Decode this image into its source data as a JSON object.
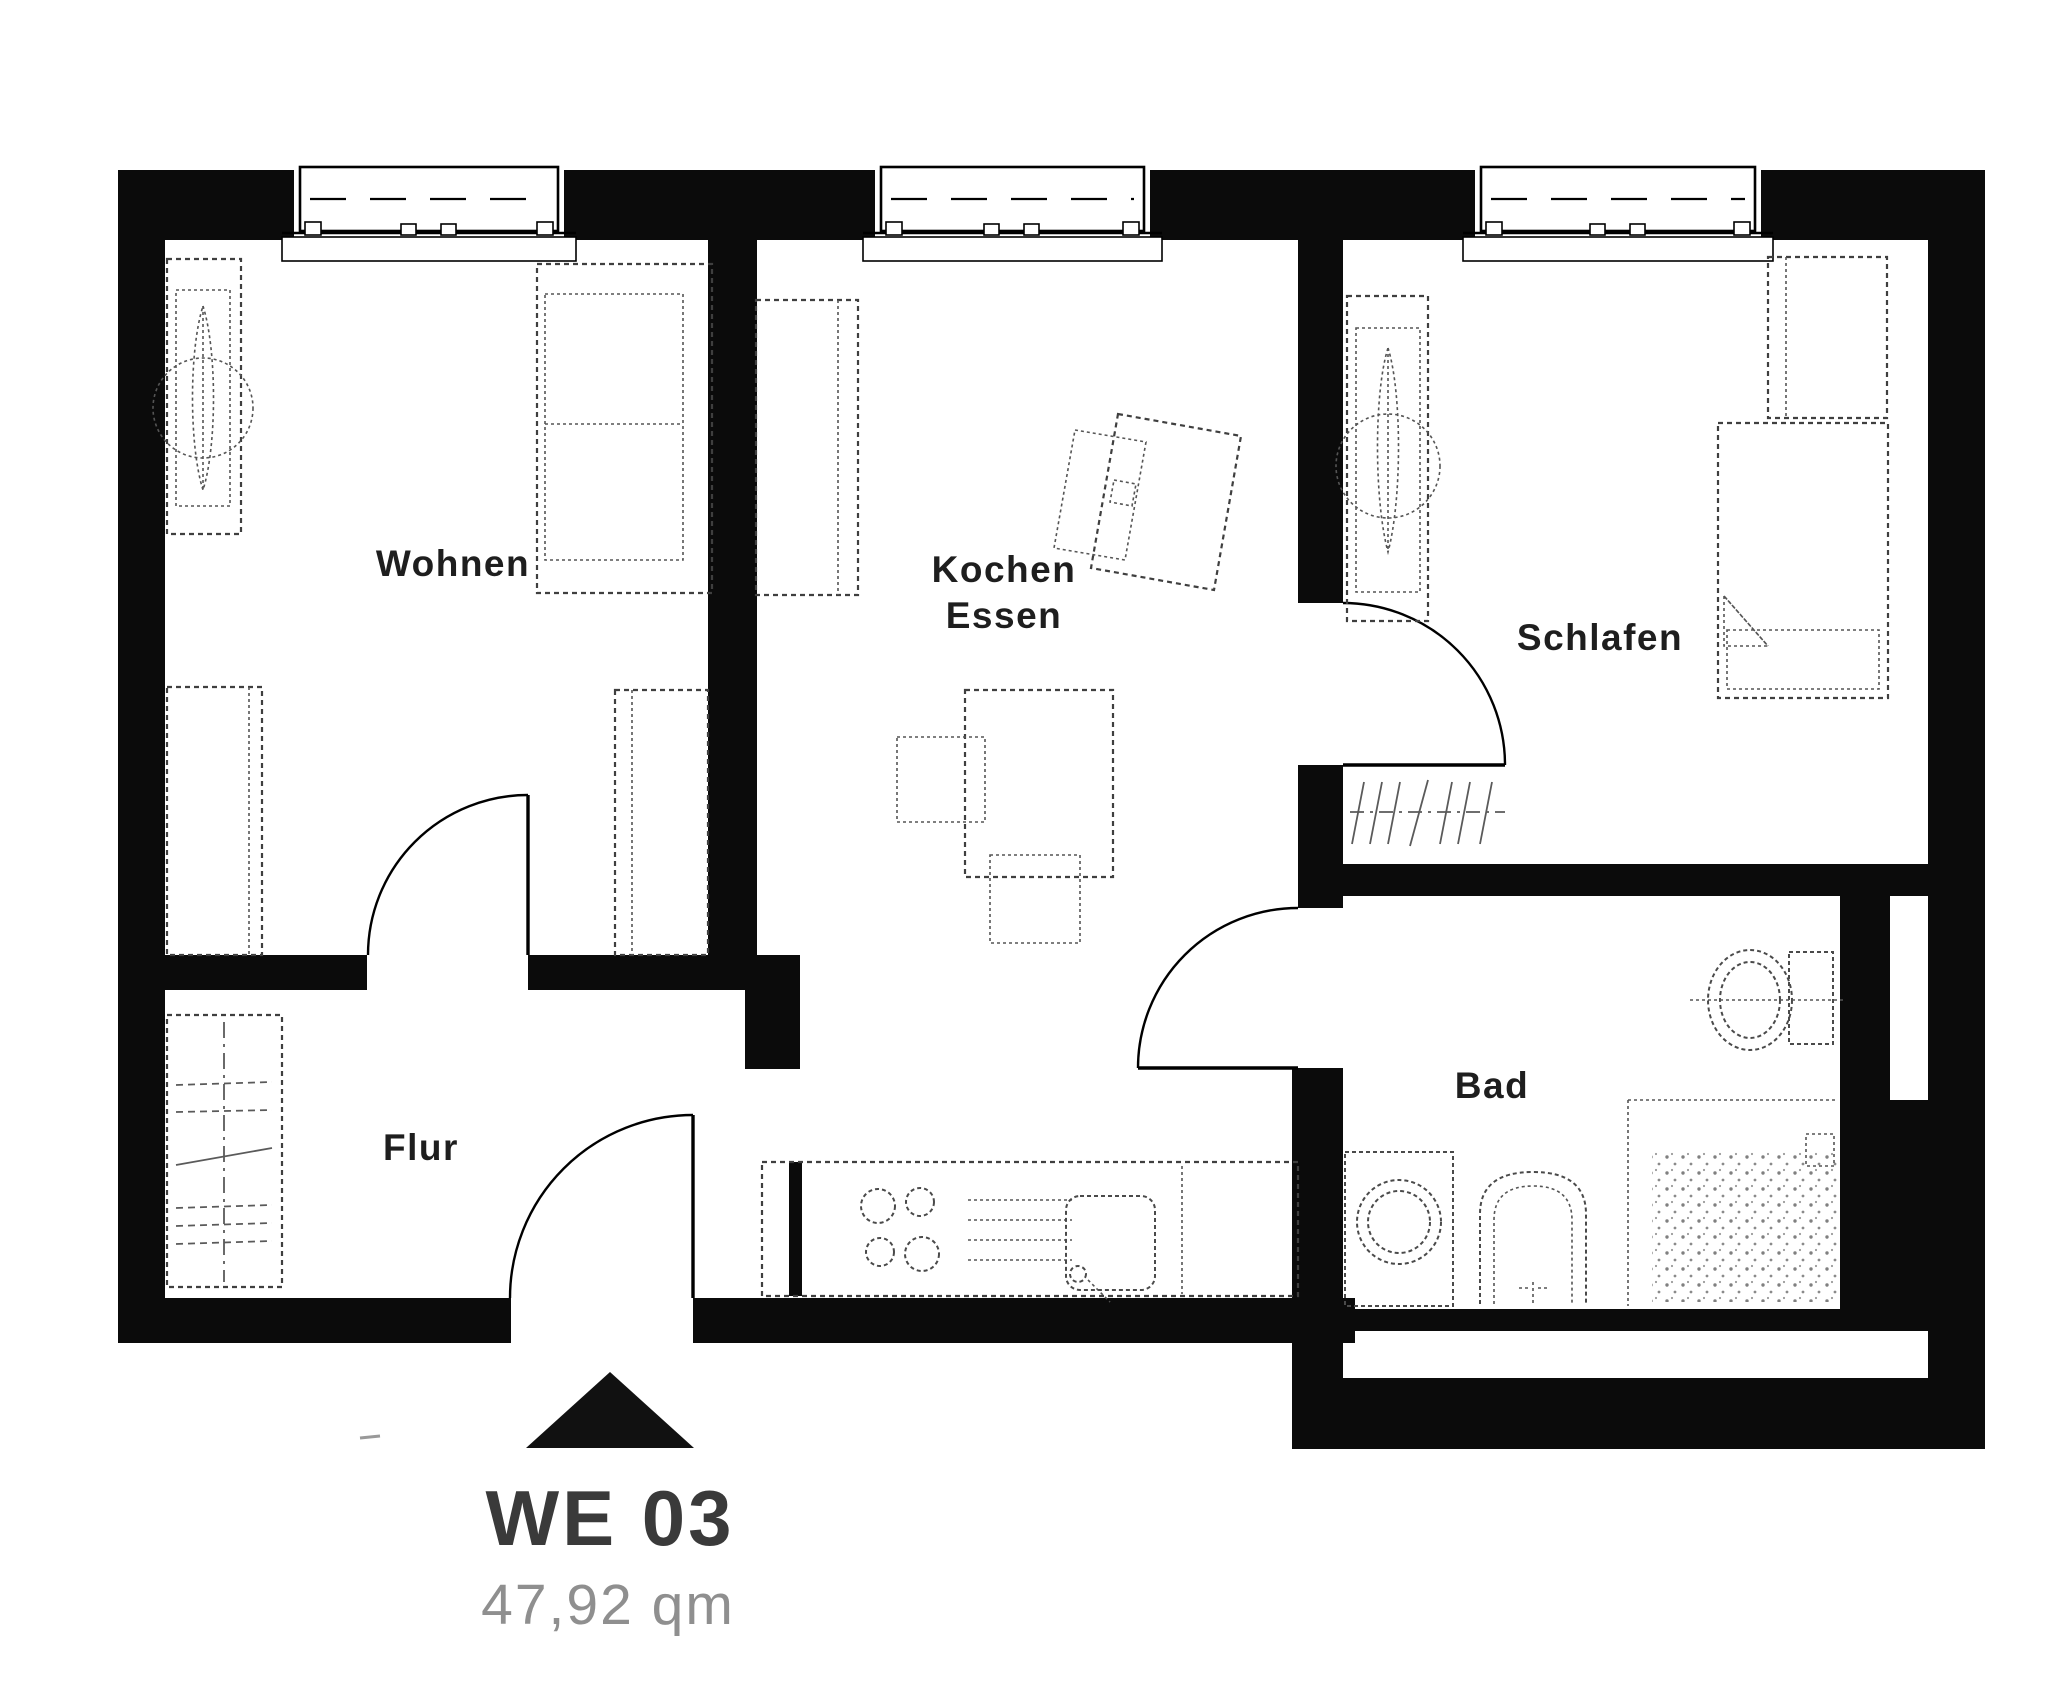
{
  "document": {
    "kind": "apartment-floor-plan",
    "background": "#ffffff"
  },
  "rooms": {
    "wohnen": {
      "label": "Wohnen"
    },
    "kochen_essen": {
      "line1": "Kochen",
      "line2": "Essen"
    },
    "schlafen": {
      "label": "Schlafen"
    },
    "flur": {
      "label": "Flur"
    },
    "bad": {
      "label": "Bad"
    }
  },
  "unit": {
    "code": "WE 03",
    "area": "47,92 qm"
  },
  "icons": {
    "entrance_arrow": "entrance-arrow-icon"
  },
  "colors": {
    "wall": "#0b0b0b",
    "furniture_line": "#3f3f3f",
    "fixture_line": "#4a4a4a",
    "door_line": "#000000",
    "room_label": "#1e1e1e",
    "unit_label": "#3a3a3a",
    "area_label": "#8f8f8f"
  }
}
